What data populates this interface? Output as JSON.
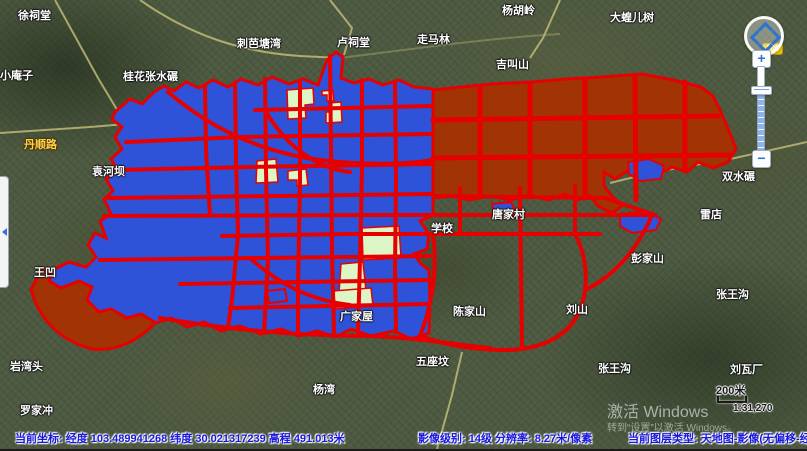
{
  "window": {
    "width": 807,
    "height": 449
  },
  "colors": {
    "overlay_blue": "#2e52d8",
    "overlay_brown": "#a23305",
    "overlay_green": "#dcf7c5",
    "road_red": "#e60000",
    "status_text_blue": "#1717dd",
    "road_badge_yellow": "#f2c500"
  },
  "map": {
    "labels": [
      {
        "text": "徐祠堂",
        "x": 18,
        "y": 7
      },
      {
        "text": "小庵子",
        "x": 0,
        "y": 67
      },
      {
        "text": "桂花张水碾",
        "x": 123,
        "y": 68
      },
      {
        "text": "刺芭塘湾",
        "x": 237,
        "y": 35
      },
      {
        "text": "卢祠堂",
        "x": 337,
        "y": 34
      },
      {
        "text": "走马林",
        "x": 417,
        "y": 31
      },
      {
        "text": "杨胡岭",
        "x": 502,
        "y": 2
      },
      {
        "text": "大蝗儿树",
        "x": 610,
        "y": 9
      },
      {
        "text": "吉叫山",
        "x": 496,
        "y": 56
      },
      {
        "text": "袁河坝",
        "x": 92,
        "y": 163
      },
      {
        "text": "双水碾",
        "x": 722,
        "y": 168
      },
      {
        "text": "雷店",
        "x": 700,
        "y": 206
      },
      {
        "text": "学校",
        "x": 431,
        "y": 220
      },
      {
        "text": "唐家村",
        "x": 492,
        "y": 206
      },
      {
        "text": "王凹",
        "x": 34,
        "y": 264
      },
      {
        "text": "彭家山",
        "x": 631,
        "y": 250
      },
      {
        "text": "刘山",
        "x": 566,
        "y": 301
      },
      {
        "text": "张王沟",
        "x": 716,
        "y": 286
      },
      {
        "text": "陈家山",
        "x": 453,
        "y": 303
      },
      {
        "text": "广家屋",
        "x": 340,
        "y": 308
      },
      {
        "text": "岩湾头",
        "x": 10,
        "y": 358
      },
      {
        "text": "杨湾",
        "x": 313,
        "y": 381
      },
      {
        "text": "五座坟",
        "x": 416,
        "y": 353
      },
      {
        "text": "罗家冲",
        "x": 20,
        "y": 402
      },
      {
        "text": "张王沟",
        "x": 598,
        "y": 360
      },
      {
        "text": "刘瓦厂",
        "x": 730,
        "y": 361
      }
    ],
    "road_labels": [
      {
        "text": "丹顺路",
        "x": 24,
        "y": 136
      }
    ],
    "road_badge": {
      "text": "106"
    }
  },
  "controls": {
    "zoom_in": "+",
    "zoom_out": "−"
  },
  "scale": {
    "distance_label": "200米",
    "ratio_label": "1:31,270"
  },
  "status_bar": {
    "coordinates": "当前坐标: 经度 103.489941268 纬度 30.021317239 高程 491.013米",
    "image_info": "影像级别: 14级  分辨率: 8.27米/像素",
    "layer_info": "当前图层类型: 天地图-影像(无偏移-经"
  },
  "watermark": {
    "line1": "激活 Windows",
    "line2": "转到“设置”以激活 Windows。"
  }
}
